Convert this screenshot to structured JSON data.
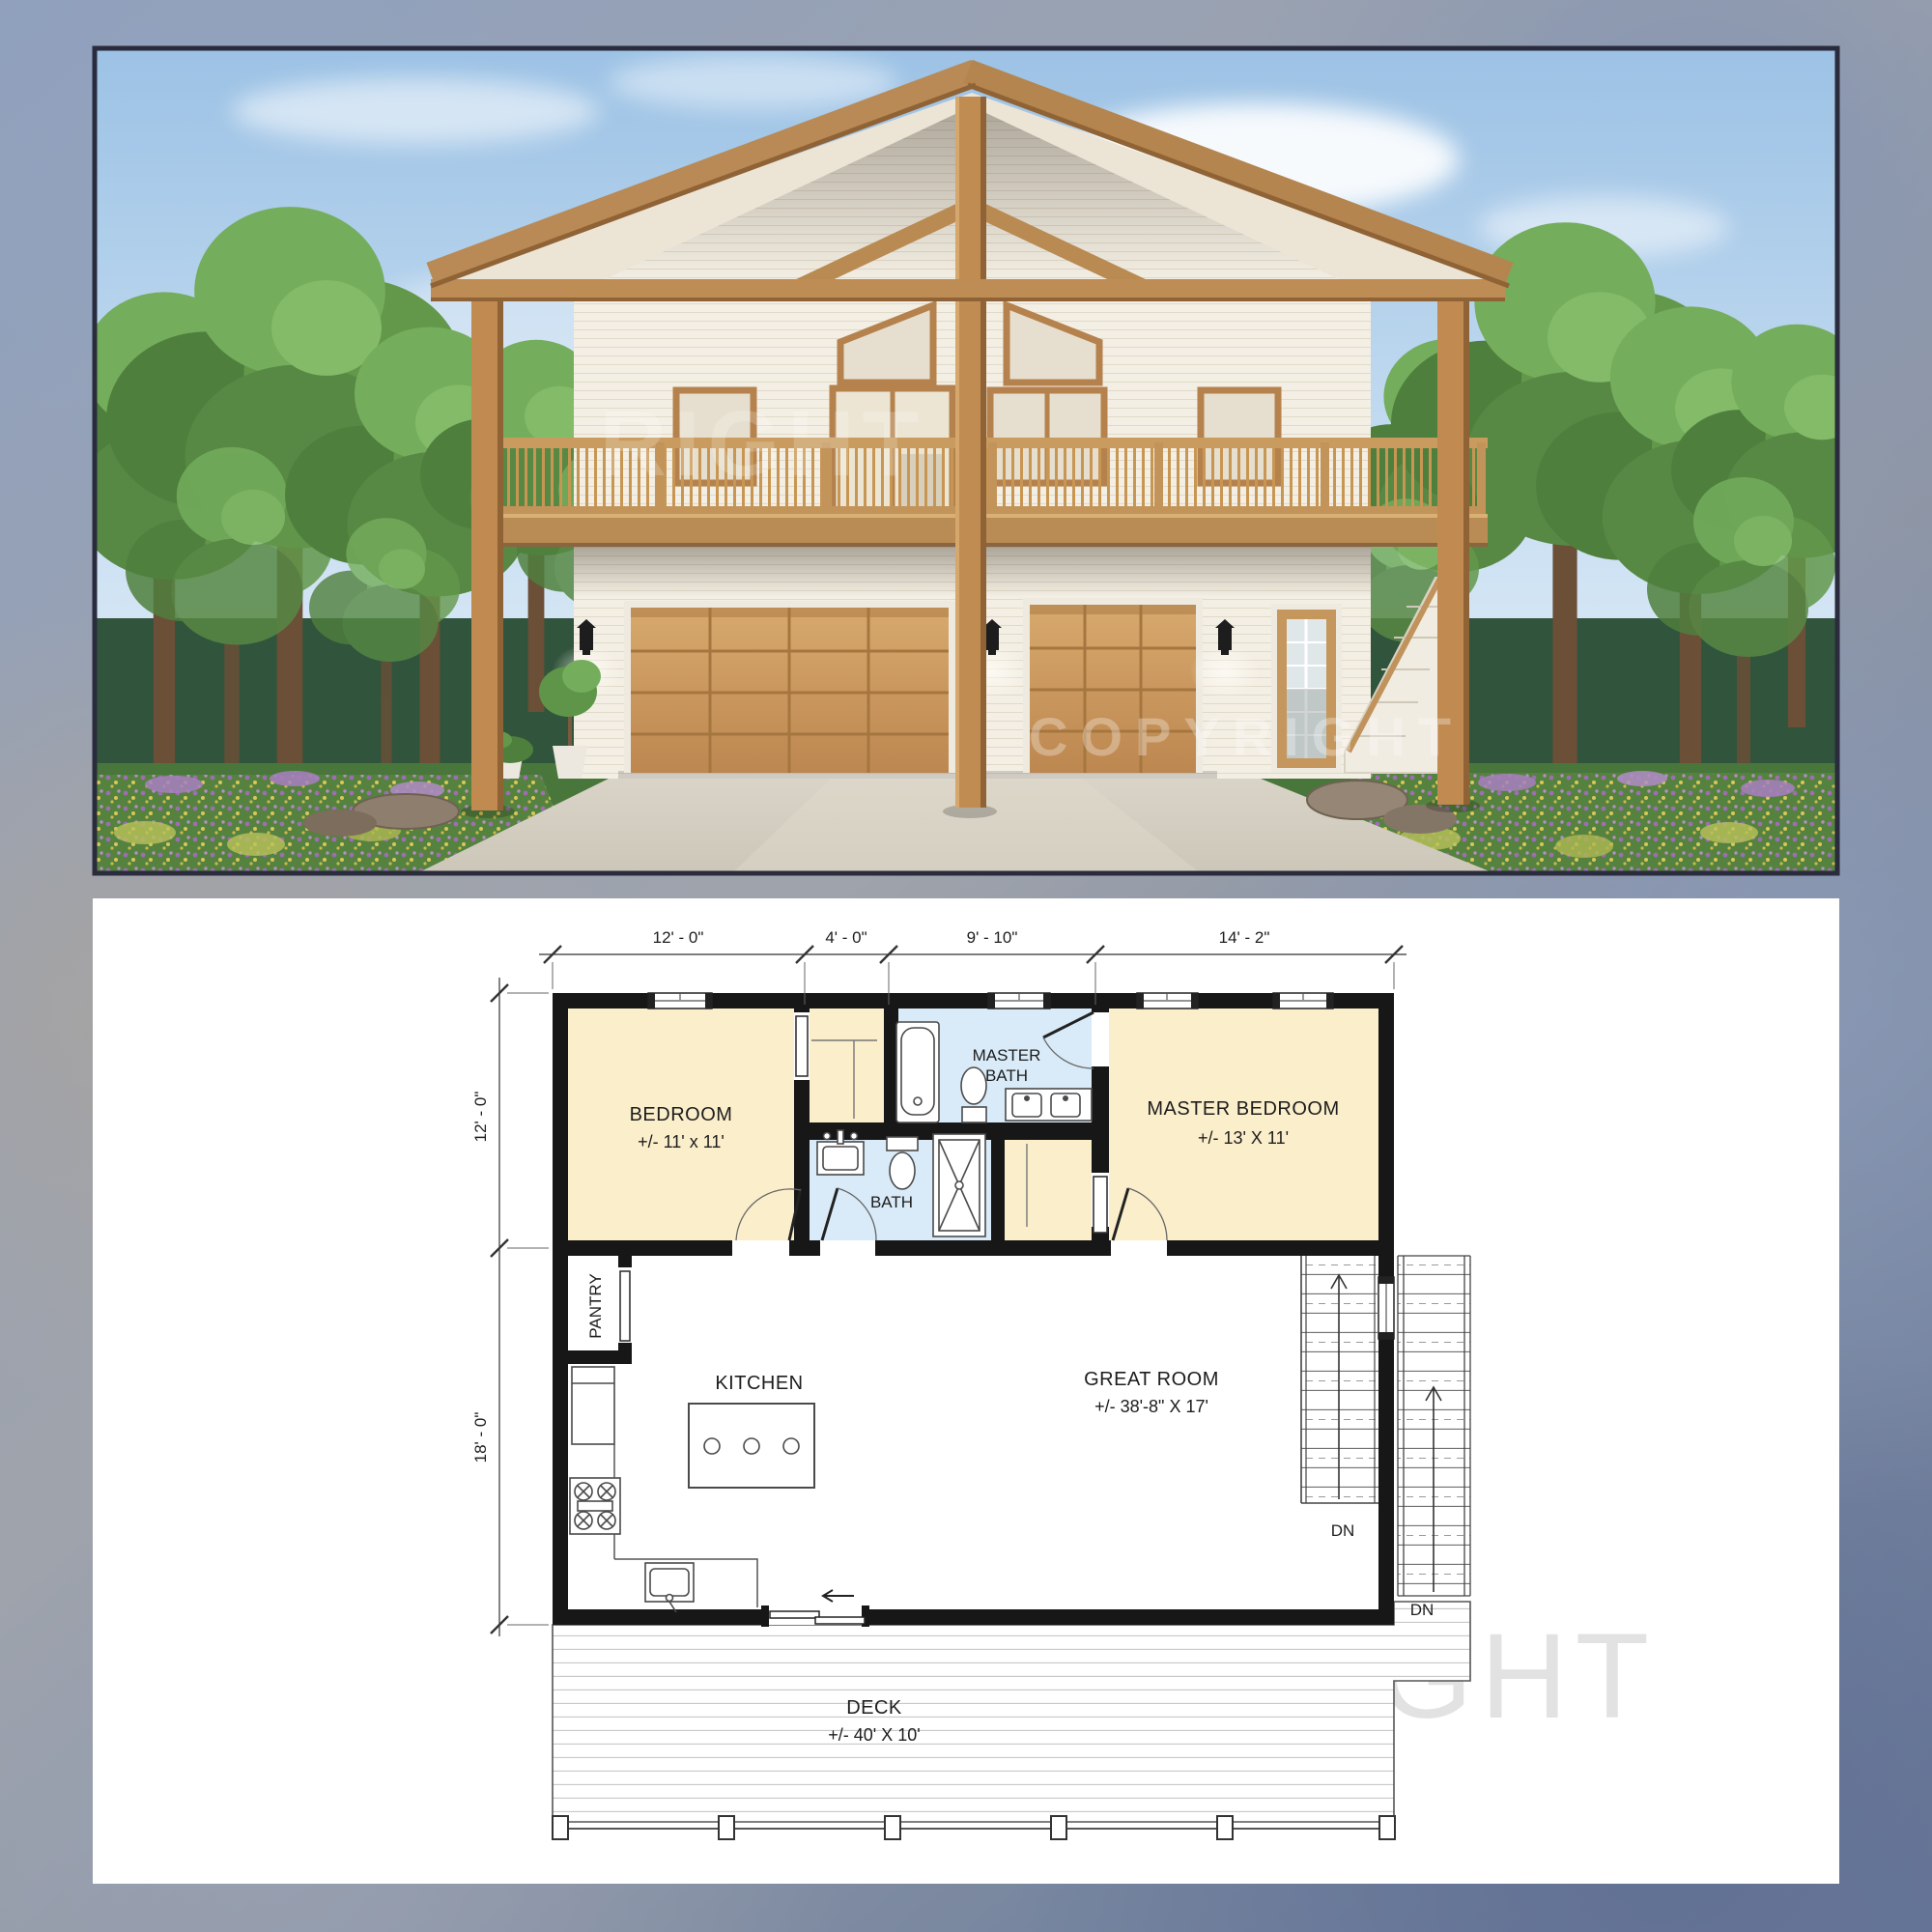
{
  "watermarks": {
    "render_upper": "RIGHT",
    "render_lower": "COPYRIGHT",
    "plan_text": "COPYRIGHT"
  },
  "plan": {
    "dims_top": [
      "12' - 0\"",
      "4' - 0\"",
      "9' - 10\"",
      "14' - 2\""
    ],
    "dims_left": [
      "12' - 0\"",
      "18' - 0\""
    ],
    "rooms": {
      "bedroom": {
        "name": "BEDROOM",
        "size": "+/- 11' x 11'"
      },
      "master_bath": {
        "line1": "MASTER",
        "line2": "BATH"
      },
      "master_bedroom": {
        "name": "MASTER BEDROOM",
        "size": "+/- 13' X 11'"
      },
      "bath": {
        "name": "BATH"
      },
      "pantry": {
        "name": "PANTRY"
      },
      "kitchen": {
        "name": "KITCHEN"
      },
      "great_room": {
        "name": "GREAT ROOM",
        "size": "+/- 38'-8\" X 17'"
      },
      "deck": {
        "name": "DECK",
        "size": "+/- 40' X 10'"
      }
    },
    "stairs": {
      "interior_label": "DN",
      "exterior_label": "DN"
    }
  },
  "colors": {
    "room_fill": "#fbeecb",
    "wet_room_fill": "#d9ebf8",
    "wall": "#171717",
    "wood": "#c08a50",
    "sky": "#9cc2e5"
  }
}
